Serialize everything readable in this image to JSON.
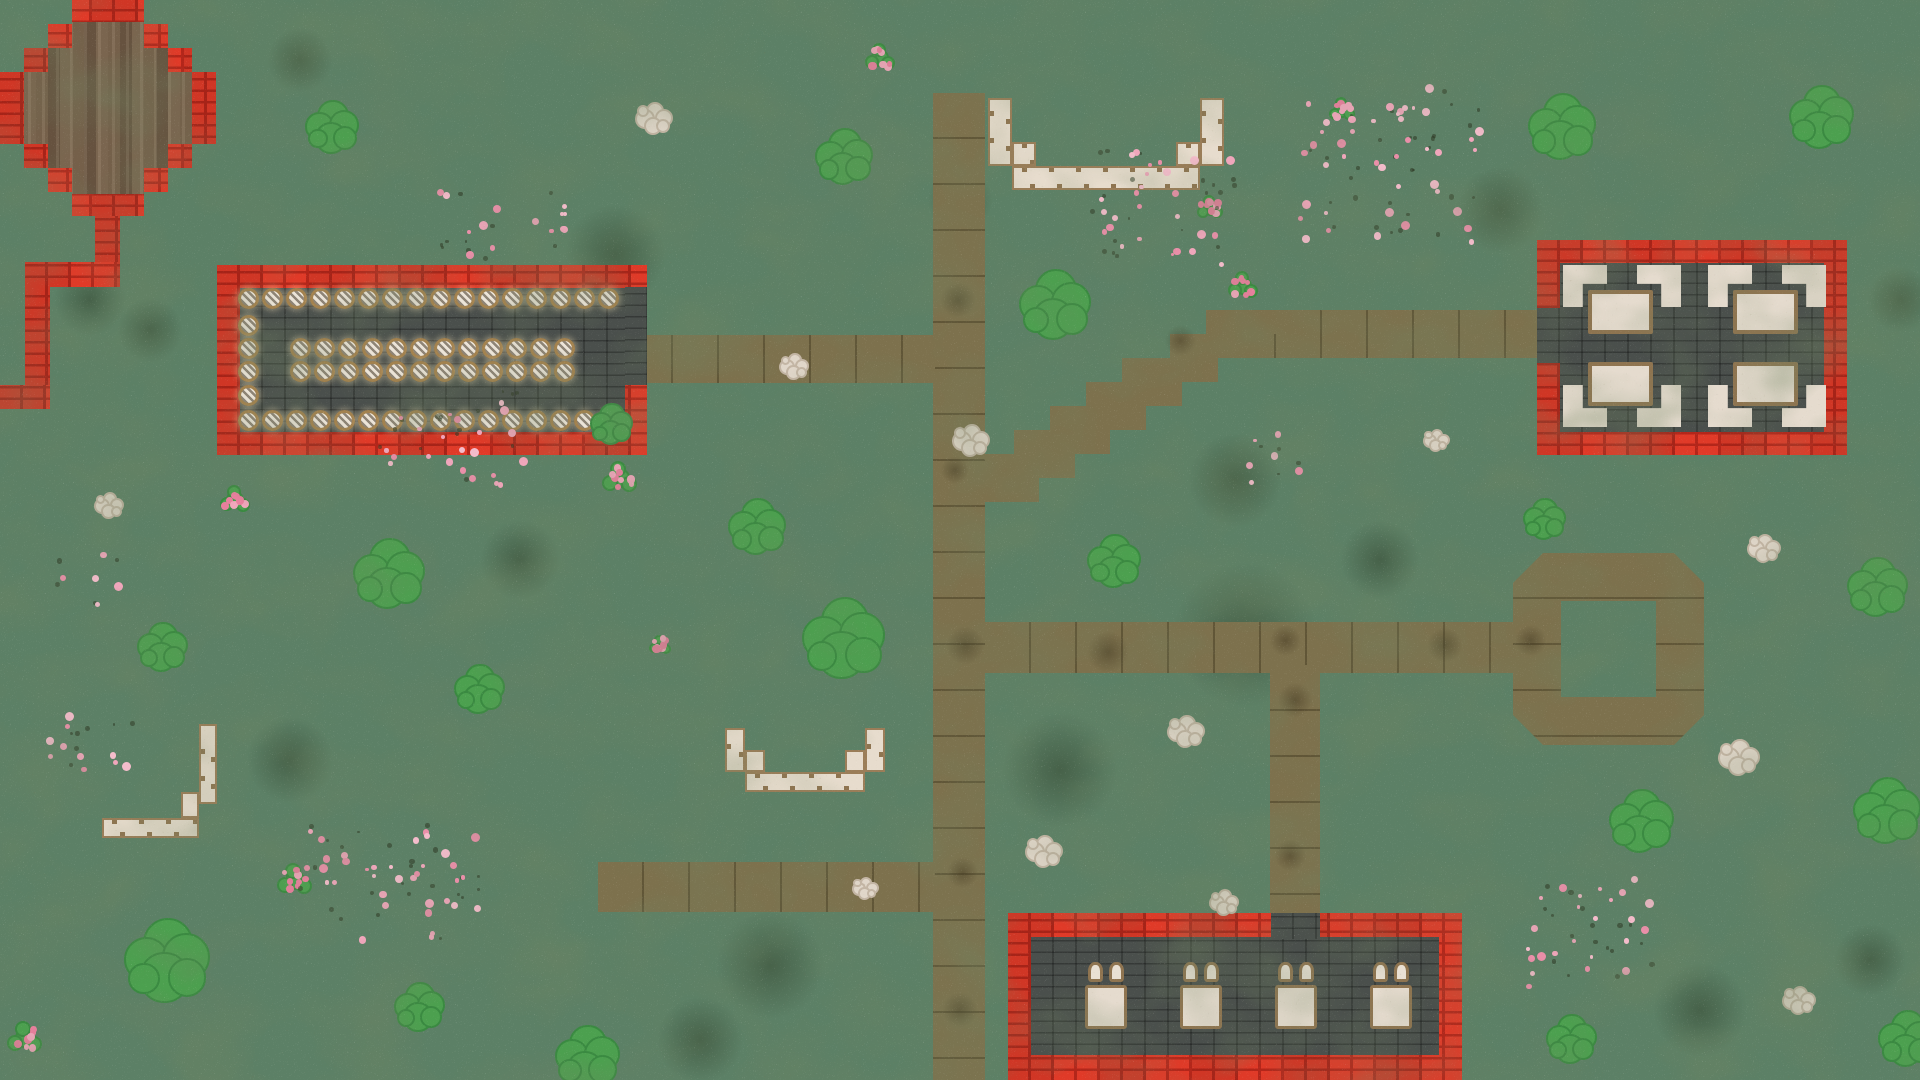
{
  "palette": {
    "grass": "#5c8066",
    "dirt": "#7d714d",
    "brick_red": "#e03a28",
    "brick_mortar": "#b3261a",
    "stone_floor": "#4a4f4c",
    "cream": "#e7dccd",
    "trim_tan": "#8f7450",
    "wood": "#6f5a45",
    "bush_green": "#4ca04f",
    "flower_pink": "#f0a6bb",
    "rock_cream": "#e0d6c9"
  },
  "world": {
    "width": 1920,
    "height": 1080
  },
  "paths": {
    "rects": [
      {
        "x": 933,
        "y": 93,
        "w": 52,
        "h": 987,
        "seam": "h"
      },
      {
        "x": 627,
        "y": 335,
        "w": 308,
        "h": 48,
        "seam": "v"
      },
      {
        "x": 1230,
        "y": 310,
        "w": 330,
        "h": 48,
        "seam": "v"
      },
      {
        "x": 985,
        "y": 622,
        "w": 535,
        "h": 51,
        "seam": "v"
      },
      {
        "x": 1270,
        "y": 665,
        "w": 50,
        "h": 250,
        "seam": "h"
      },
      {
        "x": 598,
        "y": 862,
        "w": 337,
        "h": 50,
        "seam": "v"
      }
    ],
    "stairs": [
      [
        1206,
        310,
        84
      ],
      [
        1170,
        334,
        96
      ],
      [
        1122,
        358,
        96
      ],
      [
        1086,
        382,
        96
      ],
      [
        1050,
        406,
        96
      ],
      [
        1014,
        430,
        96
      ],
      [
        985,
        454,
        90
      ],
      [
        985,
        478,
        54
      ]
    ],
    "ring": {
      "x": 1513,
      "y": 553,
      "w": 191,
      "h": 192,
      "bevel": 30,
      "hole": [
        48,
        48,
        95,
        96
      ]
    }
  },
  "plaza": {
    "x": 0,
    "y": 0,
    "w": 216,
    "h": 216,
    "brick_poly": "72px 0,144px 0,144px 24px,168px 24px,168px 48px,192px 48px,192px 72px,216px 72px,216px 144px,192px 144px,192px 168px,168px 168px,168px 192px,144px 192px,144px 216px,72px 216px,72px 192px,48px 192px,48px 168px,24px 168px,24px 144px,0 144px,0 72px,24px 72px,24px 48px,48px 48px,48px 24px,72px 24px",
    "wood_poly": "72px 22px,144px 22px,144px 48px,168px 48px,168px 72px,192px 72px,192px 144px,168px 144px,168px 168px,144px 168px,144px 194px,72px 194px,72px 168px,48px 168px,48px 144px,24px 144px,24px 72px,48px 72px,48px 48px,72px 48px",
    "zigzag": [
      [
        95,
        216,
        25,
        48
      ],
      [
        25,
        262,
        95,
        25
      ],
      [
        25,
        287,
        25,
        100
      ],
      [
        0,
        385,
        50,
        24
      ]
    ]
  },
  "range": {
    "outer": [
      217,
      265,
      430,
      190
    ],
    "floor": [
      240,
      288,
      385,
      144
    ],
    "door": [
      625,
      287,
      22,
      98
    ],
    "targets": {
      "step": 24,
      "rows": [
        {
          "y": 298,
          "runs": [
            [
              248,
              16
            ]
          ]
        },
        {
          "y": 325,
          "runs": [
            [
              248,
              1
            ]
          ]
        },
        {
          "y": 348,
          "runs": [
            [
              248,
              1
            ],
            [
              300,
              12
            ]
          ]
        },
        {
          "y": 371,
          "runs": [
            [
              248,
              1
            ],
            [
              300,
              12
            ]
          ]
        },
        {
          "y": 395,
          "runs": [
            [
              248,
              1
            ]
          ]
        },
        {
          "y": 420,
          "runs": [
            [
              248,
              16
            ]
          ]
        }
      ]
    }
  },
  "restaurant": {
    "outer": [
      1537,
      240,
      310,
      215
    ],
    "floor": [
      1560,
      263,
      264,
      169
    ],
    "door": [
      1537,
      308,
      23,
      55
    ],
    "sets": [
      {
        "table": [
          1588,
          290,
          65,
          44
        ],
        "chairs": [
          [
            1563,
            265,
            "tl"
          ],
          [
            1637,
            265,
            "tr"
          ]
        ]
      },
      {
        "table": [
          1733,
          290,
          65,
          44
        ],
        "chairs": [
          [
            1708,
            265,
            "tl"
          ],
          [
            1782,
            265,
            "tr"
          ]
        ]
      },
      {
        "table": [
          1588,
          362,
          65,
          44
        ],
        "chairs": [
          [
            1563,
            385,
            "bl"
          ],
          [
            1637,
            385,
            "br"
          ]
        ]
      },
      {
        "table": [
          1733,
          362,
          65,
          44
        ],
        "chairs": [
          [
            1708,
            385,
            "bl"
          ],
          [
            1782,
            385,
            "br"
          ]
        ]
      }
    ]
  },
  "inn": {
    "outer": [
      1008,
      913,
      454,
      167
    ],
    "floor": [
      1031,
      937,
      408,
      118
    ],
    "door": [
      1271,
      913,
      49,
      26
    ],
    "bed_y": 985,
    "bed_w": 42,
    "bed_h": 44,
    "beds": [
      {
        "x": 1085
      },
      {
        "x": 1180
      },
      {
        "x": 1275
      },
      {
        "x": 1370
      }
    ]
  },
  "walls": {
    "u_top": [
      [
        988,
        98,
        24,
        68
      ],
      [
        1012,
        142,
        24,
        24
      ],
      [
        1200,
        98,
        24,
        68
      ],
      [
        1176,
        142,
        24,
        24
      ],
      [
        1012,
        166,
        188,
        24
      ]
    ],
    "u_mid": [
      [
        725,
        728,
        20,
        44
      ],
      [
        745,
        750,
        20,
        22
      ],
      [
        865,
        728,
        20,
        44
      ],
      [
        845,
        750,
        20,
        22
      ],
      [
        745,
        772,
        120,
        20
      ]
    ],
    "l_left": [
      [
        199,
        724,
        18,
        80
      ],
      [
        181,
        792,
        18,
        26
      ],
      [
        102,
        818,
        97,
        20
      ]
    ]
  },
  "decor": {
    "bushes": [
      [
        333,
        128,
        0.75
      ],
      [
        845,
        158,
        0.8
      ],
      [
        1563,
        128,
        0.95
      ],
      [
        1822,
        118,
        0.9
      ],
      [
        1056,
        306,
        1.0
      ],
      [
        1115,
        562,
        0.75
      ],
      [
        1545,
        520,
        0.6
      ],
      [
        1878,
        588,
        0.85
      ],
      [
        390,
        575,
        1.0
      ],
      [
        163,
        648,
        0.7
      ],
      [
        845,
        640,
        1.15
      ],
      [
        480,
        690,
        0.7
      ],
      [
        168,
        962,
        1.2
      ],
      [
        420,
        1008,
        0.7
      ],
      [
        588,
        1058,
        0.9
      ],
      [
        1642,
        822,
        0.9
      ],
      [
        1888,
        812,
        0.95
      ],
      [
        1572,
        1040,
        0.7
      ],
      [
        612,
        425,
        0.6
      ],
      [
        758,
        528,
        0.8
      ],
      [
        1908,
        1040,
        0.8
      ]
    ],
    "roses": [
      [
        880,
        58,
        0.7
      ],
      [
        1210,
        208,
        0.6
      ],
      [
        1243,
        286,
        0.7
      ],
      [
        620,
        478,
        0.8
      ],
      [
        235,
        500,
        0.7
      ],
      [
        295,
        880,
        0.8
      ],
      [
        660,
        645,
        0.5
      ],
      [
        25,
        1038,
        0.8
      ],
      [
        1342,
        110,
        0.6
      ]
    ],
    "rocks": [
      [
        655,
        118,
        1
      ],
      [
        972,
        440,
        1
      ],
      [
        1187,
        731,
        1
      ],
      [
        1045,
        851,
        1
      ],
      [
        110,
        505,
        0.8
      ],
      [
        1765,
        548,
        0.9
      ],
      [
        1740,
        757,
        1.1
      ],
      [
        1800,
        1000,
        0.9
      ],
      [
        866,
        888,
        0.7
      ],
      [
        1225,
        902,
        0.8
      ],
      [
        795,
        366,
        0.8
      ],
      [
        1437,
        440,
        0.7
      ]
    ],
    "flowers": [
      [
        500,
        225,
        130,
        70
      ],
      [
        1160,
        205,
        150,
        120
      ],
      [
        1390,
        165,
        180,
        160
      ],
      [
        452,
        438,
        150,
        95
      ],
      [
        85,
        580,
        70,
        50
      ],
      [
        88,
        738,
        90,
        70
      ],
      [
        390,
        885,
        190,
        120
      ],
      [
        1598,
        932,
        140,
        110
      ],
      [
        1270,
        455,
        60,
        60
      ]
    ],
    "dark_patches": [
      [
        615,
        255,
        140
      ],
      [
        1245,
        635,
        200
      ],
      [
        1060,
        770,
        160
      ],
      [
        430,
        330,
        120
      ],
      [
        1660,
        300,
        150
      ],
      [
        770,
        965,
        150
      ],
      [
        1235,
        480,
        130
      ],
      [
        90,
        300,
        100
      ],
      [
        1500,
        210,
        120
      ],
      [
        1810,
        420,
        110
      ],
      [
        290,
        760,
        120
      ],
      [
        1700,
        1010,
        130
      ],
      [
        520,
        560,
        110
      ],
      [
        960,
        200,
        90
      ],
      [
        1380,
        560,
        110
      ],
      [
        700,
        1040,
        120
      ],
      [
        1870,
        960,
        100
      ],
      [
        300,
        60,
        90
      ],
      [
        1420,
        980,
        110
      ],
      [
        150,
        330,
        90
      ],
      [
        1900,
        300,
        90
      ]
    ],
    "road_smudges": [
      [
        958,
        300,
        50
      ],
      [
        965,
        645,
        55
      ],
      [
        1295,
        700,
        50
      ],
      [
        962,
        872,
        45
      ],
      [
        1108,
        652,
        60
      ],
      [
        1285,
        640,
        45
      ],
      [
        955,
        470,
        40
      ],
      [
        1445,
        645,
        50
      ],
      [
        1290,
        855,
        45
      ],
      [
        960,
        1010,
        50
      ],
      [
        1530,
        640,
        45
      ],
      [
        1180,
        340,
        45
      ]
    ]
  }
}
